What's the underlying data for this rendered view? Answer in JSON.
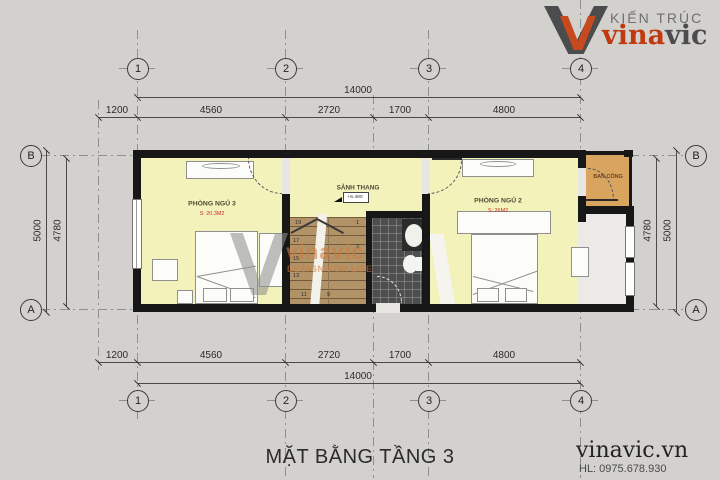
{
  "header": {
    "brand_small": "KIẾN TRÚC",
    "brand_part1": "vina",
    "brand_part2": "vic"
  },
  "watermark": {
    "brand": "vinavic",
    "tagline": "DESIGN FOR LIFE"
  },
  "plan": {
    "title": "MẶT BẰNG TẦNG 3",
    "grid_cols": [
      "1",
      "2",
      "3",
      "4"
    ],
    "grid_rows": [
      "B",
      "A"
    ],
    "dims_total": "14000",
    "dims_segments": [
      "1200",
      "4560",
      "2720",
      "1700",
      "4800"
    ],
    "dims_left_outer": "5000",
    "dims_left_inner": "4780",
    "dims_right_outer": "5000",
    "dims_right_inner": "4780",
    "rooms": {
      "bedroom3": {
        "name": "PHÒNG NGỦ 3",
        "area": "S: 20.3M2"
      },
      "bedroom2": {
        "name": "PHÒNG NGỦ 2",
        "area": "S: 26M2"
      },
      "stair_hall": {
        "name": "SẢNH THANG",
        "level": "+6.480"
      },
      "balcony": {
        "name": "BAN CÔNG"
      }
    },
    "stairs": {
      "numbers": [
        "19",
        "17",
        "15",
        "13",
        "11",
        "9",
        "1",
        "3"
      ]
    }
  },
  "footer": {
    "website": "vinavic.vn",
    "phone": "HL: 0975.678.930"
  },
  "colors": {
    "room_yellow": "#f3f2bb",
    "stair_tan": "#b19367",
    "bath_dark": "#4e4e4e",
    "balcony_orange": "#d8a45e",
    "brand_orange": "#c64a1d",
    "brand_gray": "#57575a",
    "area_red": "#c03030",
    "wall_black": "#171717"
  }
}
